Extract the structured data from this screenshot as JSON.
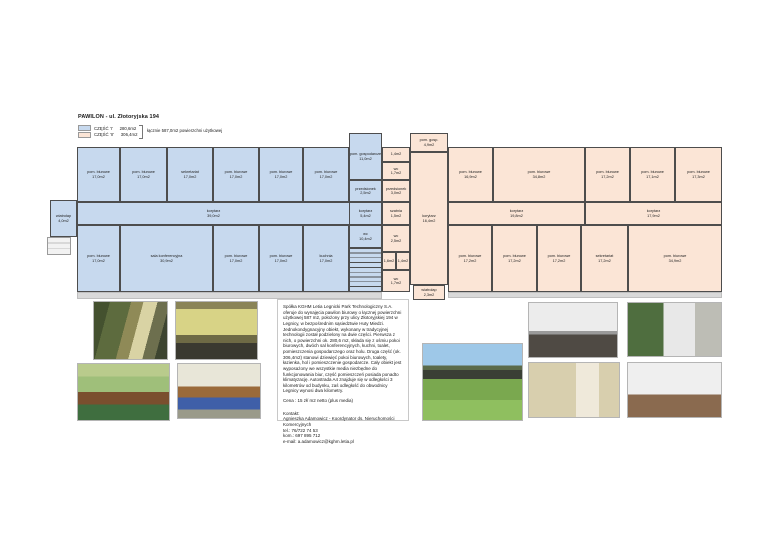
{
  "header": {
    "title": "PAWILON - ul. Złotoryjska 194",
    "legend": [
      {
        "label": "CZĘŚĆ 'I'",
        "area": "280,6m2"
      },
      {
        "label": "CZĘŚĆ 'II'",
        "area": "306,4m2"
      }
    ],
    "legend_total": "łącznie 587,0m2 powierzchni użytkowej"
  },
  "colors": {
    "section1": "#c7d9ee",
    "section2": "#fbe5d6",
    "wall": "#4d4d4d"
  },
  "floor_plan": {
    "rooms": [
      {
        "section": "I",
        "name": "pom. biurowe",
        "area": "17,0m2",
        "x": 77,
        "y": 147,
        "w": 43,
        "h": 55
      },
      {
        "section": "I",
        "name": "pom. biurowe",
        "area": "17,0m2",
        "x": 120,
        "y": 147,
        "w": 47,
        "h": 55
      },
      {
        "section": "I",
        "name": "sekretariat",
        "area": "17,0m2",
        "x": 167,
        "y": 147,
        "w": 46,
        "h": 55
      },
      {
        "section": "I",
        "name": "pom. biurowe",
        "area": "17,0m2",
        "x": 213,
        "y": 147,
        "w": 46,
        "h": 55
      },
      {
        "section": "I",
        "name": "pom. biurowe",
        "area": "17,0m2",
        "x": 259,
        "y": 147,
        "w": 44,
        "h": 55
      },
      {
        "section": "I",
        "name": "pom. biurowe",
        "area": "17,0m2",
        "x": 303,
        "y": 147,
        "w": 46,
        "h": 55
      },
      {
        "section": "I",
        "name": "korytarz",
        "area": "39,0m2",
        "x": 77,
        "y": 202,
        "w": 273,
        "h": 23
      },
      {
        "section": "I",
        "name": "pom. biurowe",
        "area": "17,0m2",
        "x": 77,
        "y": 225,
        "w": 43,
        "h": 67
      },
      {
        "section": "I",
        "name": "sala konferencyjna",
        "area": "30,9m2",
        "x": 120,
        "y": 225,
        "w": 93,
        "h": 67
      },
      {
        "section": "I",
        "name": "pom. biurowe",
        "area": "17,0m2",
        "x": 213,
        "y": 225,
        "w": 46,
        "h": 67
      },
      {
        "section": "I",
        "name": "pom. biurowe",
        "area": "17,0m2",
        "x": 259,
        "y": 225,
        "w": 44,
        "h": 67
      },
      {
        "section": "I",
        "name": "kuchnia",
        "area": "17,0m2",
        "x": 303,
        "y": 225,
        "w": 46,
        "h": 67
      },
      {
        "section": "I",
        "name": "pom. gospodarcze",
        "area": "11,0m2",
        "x": 349,
        "y": 133,
        "w": 33,
        "h": 47
      },
      {
        "section": "I",
        "name": "przedsionek",
        "area": "2,5m2",
        "x": 349,
        "y": 180,
        "w": 33,
        "h": 22
      },
      {
        "section": "I",
        "name": "korytarz",
        "area": "5,4m2",
        "x": 349,
        "y": 202,
        "w": 33,
        "h": 23
      },
      {
        "section": "I",
        "name": "wc",
        "area": "10,4m2",
        "x": 349,
        "y": 225,
        "w": 33,
        "h": 23
      },
      {
        "section": "I",
        "name": "klatka schodowa",
        "area": "",
        "x": 349,
        "y": 248,
        "w": 33,
        "h": 44,
        "stairs": true
      },
      {
        "section": "I",
        "name": "wiatrołap",
        "area": "4,0m2",
        "x": 50,
        "y": 200,
        "w": 27,
        "h": 37
      },
      {
        "section": "II",
        "name": "",
        "area": "1,4m2",
        "x": 382,
        "y": 147,
        "w": 28,
        "h": 15
      },
      {
        "section": "II",
        "name": "wc",
        "area": "1,7m2",
        "x": 382,
        "y": 162,
        "w": 28,
        "h": 18
      },
      {
        "section": "II",
        "name": "przedsionek",
        "area": "3,0m2",
        "x": 382,
        "y": 180,
        "w": 28,
        "h": 22
      },
      {
        "section": "II",
        "name": "szatnia",
        "area": "1,5m2",
        "x": 382,
        "y": 202,
        "w": 28,
        "h": 23
      },
      {
        "section": "II",
        "name": "wc",
        "area": "2,5m2",
        "x": 382,
        "y": 225,
        "w": 28,
        "h": 27
      },
      {
        "section": "II",
        "name": "",
        "area": "1,6m2",
        "x": 382,
        "y": 252,
        "w": 14,
        "h": 18
      },
      {
        "section": "II",
        "name": "",
        "area": "1,4m2",
        "x": 396,
        "y": 252,
        "w": 14,
        "h": 18
      },
      {
        "section": "II",
        "name": "wc",
        "area": "1,7m2",
        "x": 382,
        "y": 270,
        "w": 28,
        "h": 22
      },
      {
        "section": "II",
        "name": "pom. gosp.",
        "area": "4,9m2",
        "x": 410,
        "y": 133,
        "w": 38,
        "h": 19
      },
      {
        "section": "II",
        "name": "korytarz",
        "area": "16,4m2",
        "x": 410,
        "y": 152,
        "w": 38,
        "h": 133
      },
      {
        "section": "II",
        "name": "wiatrołap",
        "area": "2,3m2",
        "x": 413,
        "y": 285,
        "w": 32,
        "h": 15
      },
      {
        "section": "II",
        "name": "pom. biurowe",
        "area": "16,9m2",
        "x": 448,
        "y": 147,
        "w": 45,
        "h": 55
      },
      {
        "section": "II",
        "name": "pom. biurowe",
        "area": "34,8m2",
        "x": 493,
        "y": 147,
        "w": 92,
        "h": 55
      },
      {
        "section": "II",
        "name": "pom. biurowe",
        "area": "17,2m2",
        "x": 585,
        "y": 147,
        "w": 45,
        "h": 55
      },
      {
        "section": "II",
        "name": "pom. biurowe",
        "area": "17,1m2",
        "x": 630,
        "y": 147,
        "w": 45,
        "h": 55
      },
      {
        "section": "II",
        "name": "pom. biurowe",
        "area": "17,3m2",
        "x": 675,
        "y": 147,
        "w": 47,
        "h": 55
      },
      {
        "section": "II",
        "name": "korytarz",
        "area": "19,8m2",
        "x": 448,
        "y": 202,
        "w": 137,
        "h": 23
      },
      {
        "section": "II",
        "name": "korytarz",
        "area": "17,9m2",
        "x": 585,
        "y": 202,
        "w": 137,
        "h": 23
      },
      {
        "section": "II",
        "name": "pom. biurowe",
        "area": "17,2m2",
        "x": 448,
        "y": 225,
        "w": 44,
        "h": 67
      },
      {
        "section": "II",
        "name": "pom. biurowe",
        "area": "17,2m2",
        "x": 492,
        "y": 225,
        "w": 45,
        "h": 67
      },
      {
        "section": "II",
        "name": "pom. biurowe",
        "area": "17,2m2",
        "x": 537,
        "y": 225,
        "w": 44,
        "h": 67
      },
      {
        "section": "II",
        "name": "sekretariat",
        "area": "17,2m2",
        "x": 581,
        "y": 225,
        "w": 47,
        "h": 67
      },
      {
        "section": "II",
        "name": "pom. biurowe",
        "area": "34,9m2",
        "x": 628,
        "y": 225,
        "w": 94,
        "h": 67
      }
    ]
  },
  "photos": [
    {
      "id": "photo-exterior-trees",
      "alt": "exterior wall with trees"
    },
    {
      "id": "photo-corridor-yellow",
      "alt": "yellow interior corridor"
    },
    {
      "id": "photo-conference-green",
      "alt": "green conference room"
    },
    {
      "id": "photo-meeting-blue-chairs",
      "alt": "meeting room with blue chairs"
    },
    {
      "id": "photo-building-lawn",
      "alt": "building behind lawn and trees"
    },
    {
      "id": "photo-corridor-white",
      "alt": "white corridor"
    },
    {
      "id": "photo-entrance",
      "alt": "building entrance with greenery"
    },
    {
      "id": "photo-bathroom",
      "alt": "tiled bathroom"
    },
    {
      "id": "photo-empty-room",
      "alt": "empty office room"
    }
  ],
  "description": {
    "paragraph": "Spółka KGHM Letia Legnicki Park Technologiczny S.A. oferuje do wynajęcia pawilon biurowy o łącznej powierzchni użytkowej 587 m2, położony przy ulicy Złotoryjskiej 194 w Legnicy, w bezpośrednim sąsiedztwie Huty Miedzi. Jednokondygnacyjny obiekt, wykonany w tradycyjnej technologii został podzielony na dwie części. Pierwsza z nich, o powierzchni ok. 280,6 m2, składa się z ośmiu pokoi biurowych, dwóch sal konferencyjnych, kuchni, toalet, pomieszczenia gospodarczego oraz holu. Druga część (ok. 306,4m2) stanowi dziewięć pokoi biurowych, toalety, łazienka, hol i pomieszczenie gospodarcze. Cały obiekt jest wyposażony we wszystkie media niezbędne do funkcjonowania biur, część pomieszczeń posiada ponadto klimatyzację. Autostrada A4 znajduje się w odległości 3 kilometrów od budynku, zaś odległość do obwodnicy Legnicy wynosi dwa kilometry.",
    "price": "Cena : 15 zł/ m2 netto (plus media)",
    "contact_heading": "Kontakt:",
    "contact_lines": [
      "Agnieszka Adamowicz - Koordynator ds. Nieruchomości Komercyjnych",
      "tel.: 76/722 74 53",
      "kom.: 697 895 712",
      "e-mail: a.adamowicz@kghm.letia.pl"
    ]
  }
}
